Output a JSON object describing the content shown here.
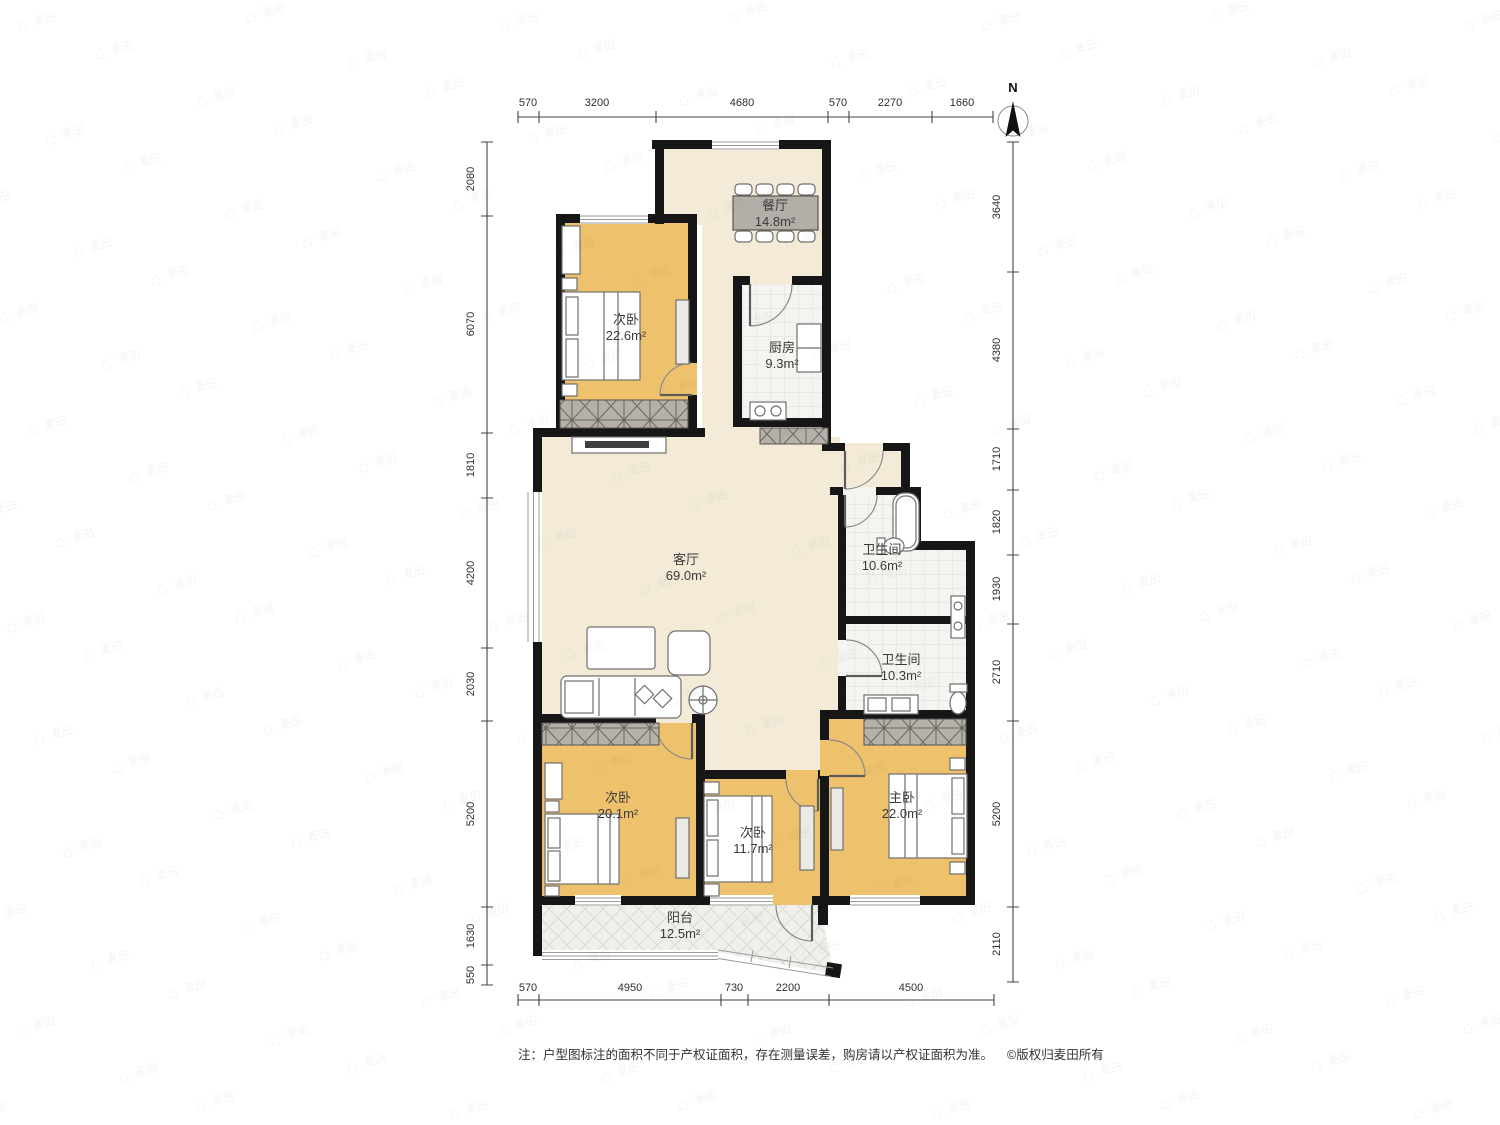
{
  "compass": {
    "label": "N"
  },
  "rooms": {
    "dining": {
      "name": "餐厅",
      "area": "14.8m²"
    },
    "bedroom_top": {
      "name": "次卧",
      "area": "22.6m²"
    },
    "kitchen": {
      "name": "厨房",
      "area": "9.3m²"
    },
    "living": {
      "name": "客厅",
      "area": "69.0m²"
    },
    "bath_upper": {
      "name": "卫生间",
      "area": "10.6m²"
    },
    "bath_lower": {
      "name": "卫生间",
      "area": "10.3m²"
    },
    "bedroom_left": {
      "name": "次卧",
      "area": "20.1m²"
    },
    "bedroom_mid": {
      "name": "次卧",
      "area": "11.7m²"
    },
    "master": {
      "name": "主卧",
      "area": "22.0m²"
    },
    "balcony": {
      "name": "阳台",
      "area": "12.5m²"
    }
  },
  "dimensions": {
    "top": [
      "570",
      "3200",
      "4680",
      "570",
      "2270",
      "1660"
    ],
    "bottom": [
      "570",
      "4950",
      "730",
      "2200",
      "4500"
    ],
    "left": [
      "2080",
      "6070",
      "1810",
      "4200",
      "2030",
      "5200",
      "1630",
      "550"
    ],
    "right": [
      "3640",
      "4380",
      "1710",
      "1820",
      "1930",
      "2710",
      "5200",
      "2110"
    ]
  },
  "note": {
    "text": "注：户型图标注的面积不同于产权证面积，存在测量误差，购房请以产权证面积为准。",
    "copyright": "©版权归麦田所有"
  },
  "watermark": {
    "icon": "⌂",
    "text": "麦田"
  },
  "colors": {
    "wall": "#161616",
    "living_floor": "#f3ebd8",
    "bedroom_floor": "#eec16d",
    "tile_floor": "#f4f4f1",
    "balcony_floor": "#f0efeb",
    "furniture_gray": "#b3afa8",
    "dim_line": "#444444"
  }
}
